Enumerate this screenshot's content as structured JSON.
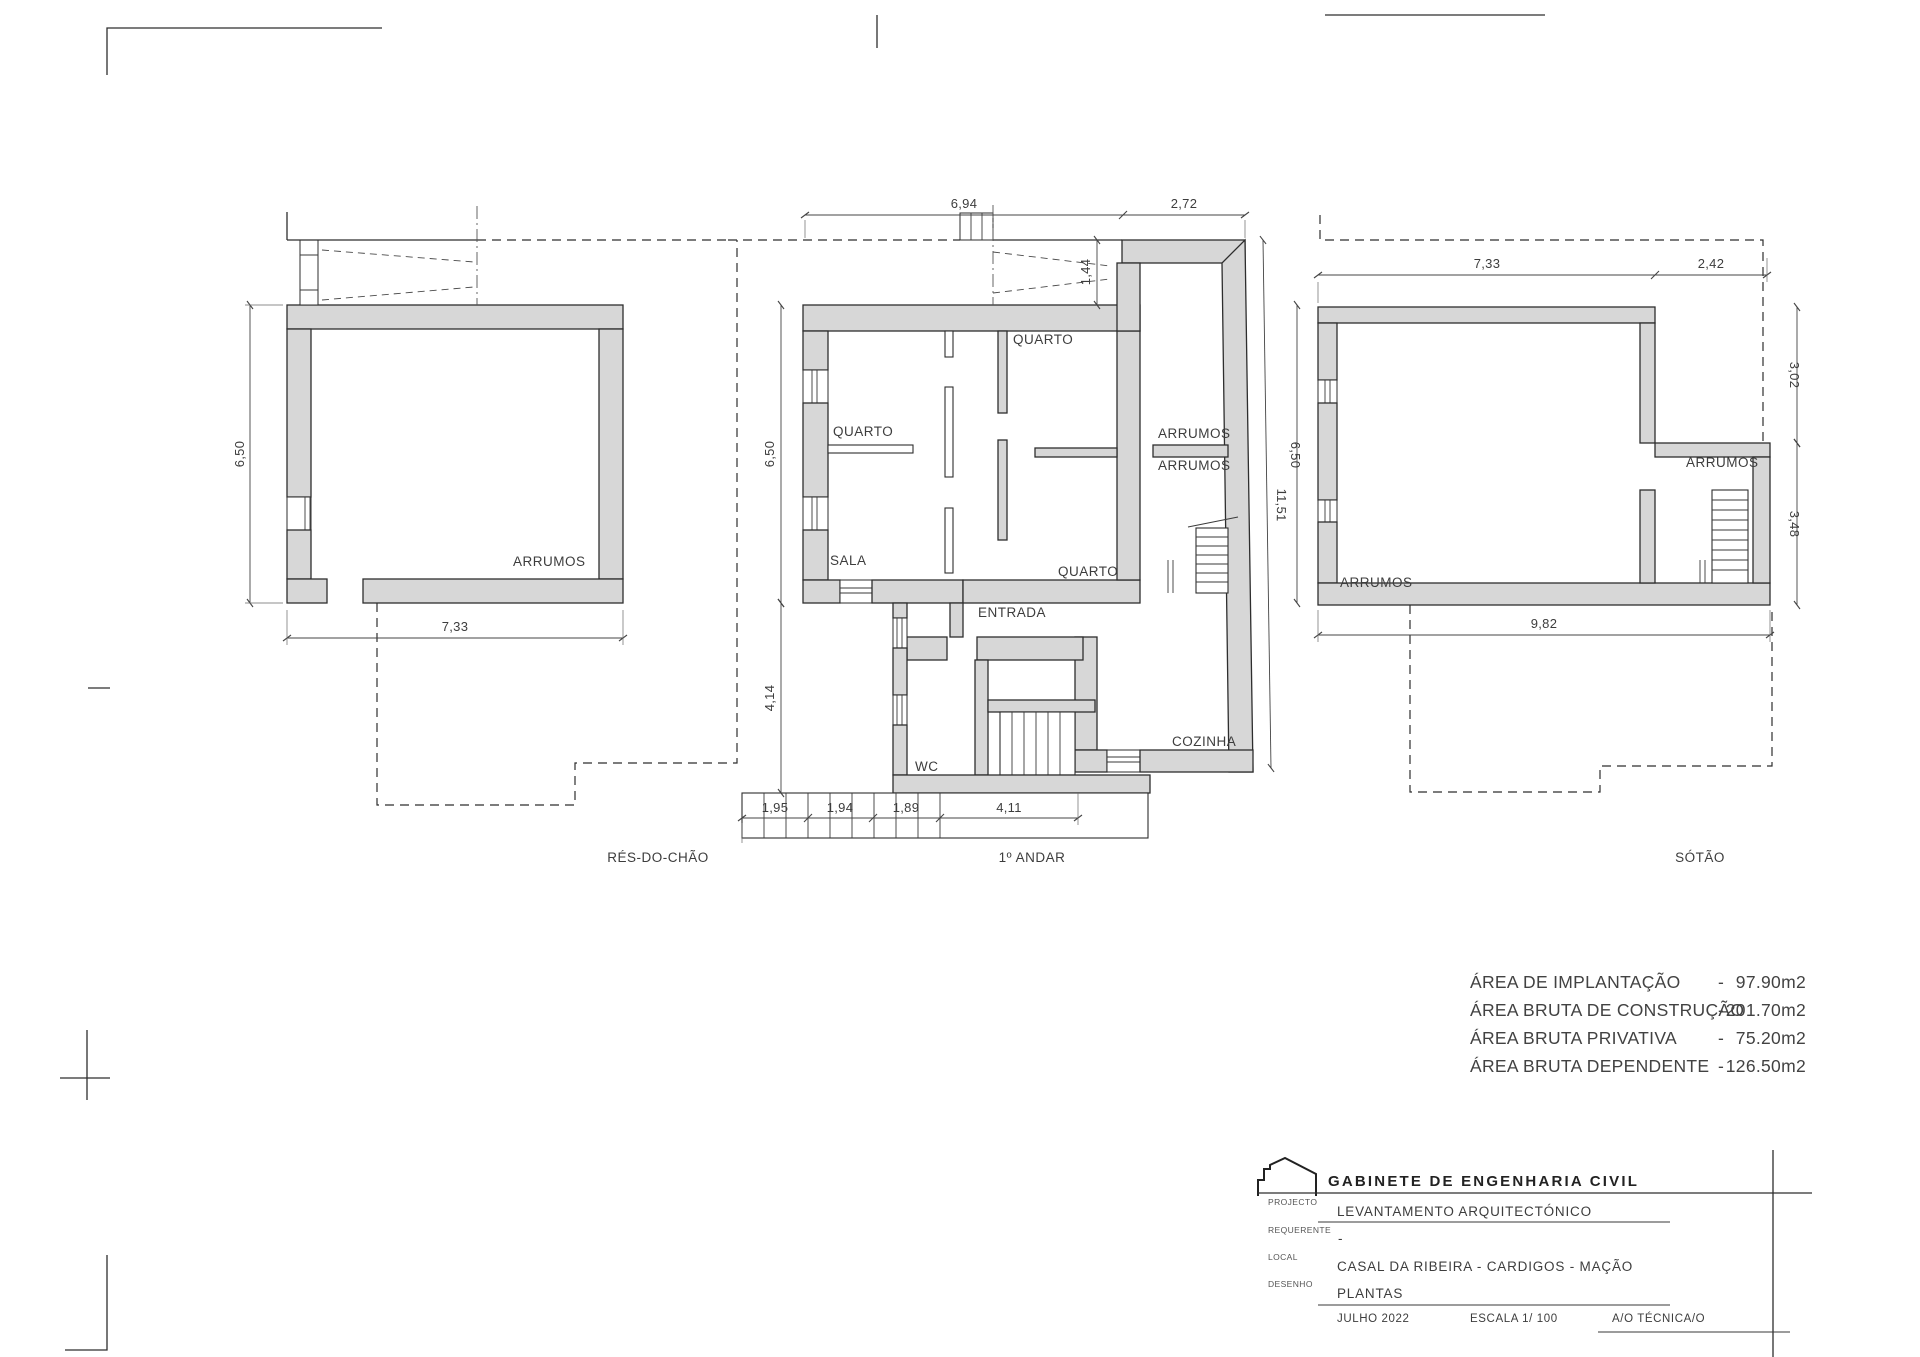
{
  "ground": {
    "floor_label": "RÉS-DO-CHÃO",
    "arrumos": "ARRUMOS",
    "dim_width": "7,33",
    "dim_height": "6,50"
  },
  "first": {
    "floor_label": "1º ANDAR",
    "quarto_tl": "QUARTO",
    "quarto_tr": "QUARTO",
    "quarto_br": "QUARTO",
    "sala": "SALA",
    "entrada": "ENTRADA",
    "wc": "WC",
    "cozinha": "COZINHA",
    "arrumos_upper": "ARRUMOS",
    "arrumos_lower": "ARRUMOS",
    "dim_top_main": "6,94",
    "dim_top_wing": "2,72",
    "dim_chimney": "1,44",
    "dim_left_upper": "6,50",
    "dim_left_lower": "4,14",
    "dim_right_total": "11,51",
    "dim_right_main": "6,50",
    "dim_bottom_1": "1,95",
    "dim_bottom_2": "1,94",
    "dim_bottom_3": "1,89",
    "dim_bottom_4": "4,11"
  },
  "attic": {
    "floor_label": "SÓTÃO",
    "arrumos_main": "ARRUMOS",
    "arrumos_right": "ARRUMOS",
    "dim_top_main": "7,33",
    "dim_top_right": "2,42",
    "dim_right_upper": "3,02",
    "dim_right_lower": "3,48",
    "dim_bottom": "9,82"
  },
  "areas": {
    "dash": "-",
    "rows": [
      {
        "label": "ÁREA DE IMPLANTAÇÃO",
        "value": "97.90m2"
      },
      {
        "label": "ÁREA BRUTA DE CONSTRUÇÃO",
        "value": "201.70m2"
      },
      {
        "label": "ÁREA BRUTA PRIVATIVA",
        "value": "75.20m2"
      },
      {
        "label": "ÁREA BRUTA DEPENDENTE",
        "value": "126.50m2"
      }
    ]
  },
  "title_block": {
    "company": "GABINETE DE ENGENHARIA CIVIL",
    "projecto_label": "PROJECTO",
    "projecto": "LEVANTAMENTO ARQUITECTÓNICO",
    "requerente_label": "REQUERENTE",
    "requerente": "-",
    "local_label": "LOCAL",
    "local": "CASAL DA RIBEIRA - CARDIGOS - MAÇÃO",
    "desenho_label": "DESENHO",
    "desenho": "PLANTAS",
    "date": "JULHO 2022",
    "scale": "ESCALA 1/ 100",
    "technician": "A/O TÉCNICA/O"
  }
}
